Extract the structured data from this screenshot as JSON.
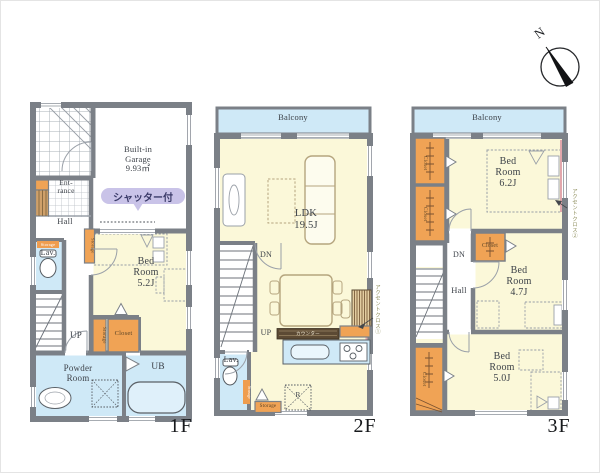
{
  "compass": {
    "north": "N"
  },
  "colors": {
    "wall_gray": "#7b8087",
    "room_yellow": "#fbf8d9",
    "water_blue": "#cfe9f7",
    "closet_orange": "#f0a355",
    "badge_purple": "#c9c3e8",
    "counter_brown": "#5c4a34",
    "accent_pink": "#e2a7ac"
  },
  "floors": {
    "f1": {
      "tag": "1F",
      "garage_l1": "Built-in",
      "garage_l2": "Garage",
      "garage_l3": "9.93㎡",
      "shutter": "シャッター付",
      "entrance_l1": "Ent-",
      "entrance_l2": "rance",
      "hall": "Hall",
      "lav": "Lav.",
      "lav_storage": "Storage",
      "storage_side": "Storage",
      "up": "UP",
      "storage2": "Storage",
      "closet": "Closet",
      "bed_l1": "Bed",
      "bed_l2": "Room",
      "bed_l3": "5.2J",
      "powder_l1": "Powder",
      "powder_l2": "Room",
      "ub": "UB"
    },
    "f2": {
      "tag": "2F",
      "balcony": "Balcony",
      "ldk_l1": "LDK",
      "ldk_l2": "19.5J",
      "dn": "DN",
      "up": "UP",
      "lav": "Lav.",
      "lav_storage": "Storage",
      "storage": "Storage",
      "counter": "カウンター",
      "fridge": "R",
      "accent": "アクセントクロス①"
    },
    "f3": {
      "tag": "3F",
      "balcony": "Balcony",
      "bed62_l1": "Bed",
      "bed62_l2": "Room",
      "bed62_l3": "6.2J",
      "bed47_l1": "Bed",
      "bed47_l2": "Room",
      "bed47_l3": "4.7J",
      "bed50_l1": "Bed",
      "bed50_l2": "Room",
      "bed50_l3": "5.0J",
      "closet_a": "Closet",
      "closet_b": "Closet",
      "closet_c": "Closet",
      "closet_d": "Closet",
      "dn": "DN",
      "hall": "Hall",
      "accent": "アクセントクロス②"
    }
  }
}
